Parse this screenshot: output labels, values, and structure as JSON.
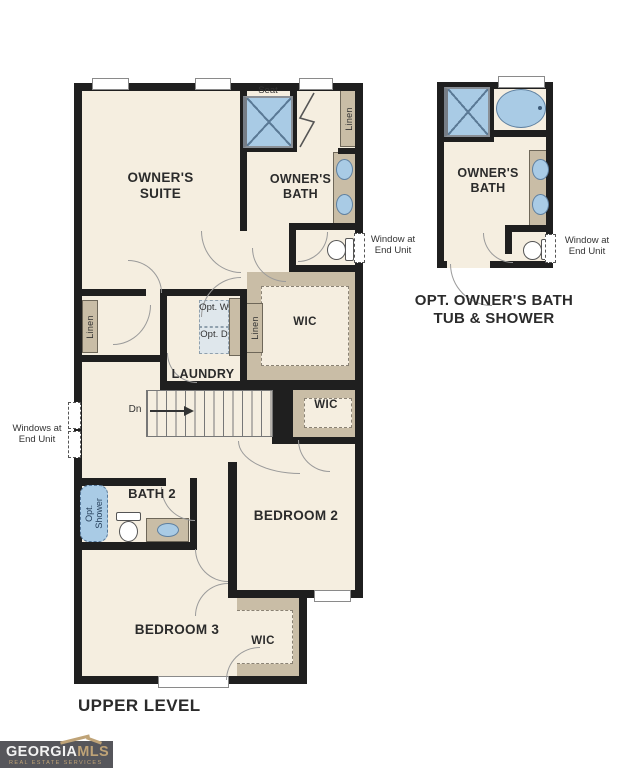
{
  "colors": {
    "wall": "#1f1f1f",
    "floor": "#f5eee0",
    "closet_tan": "#c9bda6",
    "fixture_blue": "#a9cbe5",
    "fixture_outline": "#5f80a0",
    "door_arc": "#9a9a9a",
    "text": "#2b2b2b",
    "logo_background": "#56565b",
    "logo_gold": "#bfa377"
  },
  "main_plan": {
    "level_title": "UPPER LEVEL",
    "rooms": {
      "owners_suite": "OWNER'S SUITE",
      "owners_bath": "OWNER'S BATH",
      "laundry": "LAUNDRY",
      "bath2": "BATH 2",
      "bedroom2": "BEDROOM 2",
      "bedroom3": "BEDROOM 3",
      "wic_owner": "WIC",
      "wic_bedroom2": "WIC",
      "wic_bedroom3": "WIC"
    },
    "labels": {
      "seat": "Seat",
      "linen_bath": "Linen",
      "linen_wic": "Linen",
      "linen_hall": "Linen",
      "opt_washer": "Opt. W",
      "opt_dryer": "Opt. D",
      "opt_shower": "Opt. Shower",
      "stairs_down": "Dn"
    },
    "annotations": {
      "window_right": "Window at End Unit",
      "windows_left": "Windows at End Unit"
    }
  },
  "optional_plan": {
    "room": "OWNER'S BATH",
    "caption_line1": "OPT. OWNER'S BATH",
    "caption_line2": "TUB & SHOWER",
    "window_note": "Window at End Unit"
  },
  "logo": {
    "brand_primary": "GEORGIA",
    "brand_secondary": "MLS",
    "tagline": "REAL ESTATE SERVICES"
  }
}
